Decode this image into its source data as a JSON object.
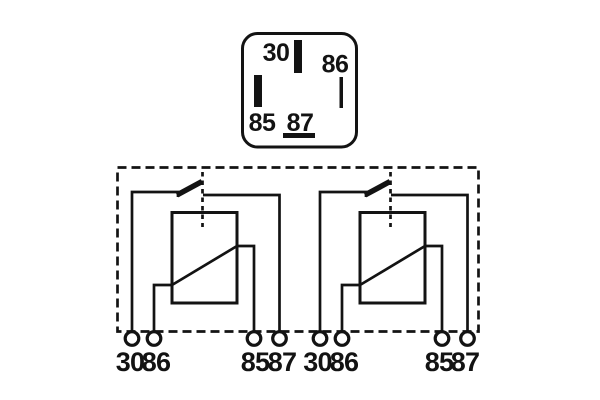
{
  "colors": {
    "ink": "#131313",
    "background": "#ffffff"
  },
  "socket": {
    "pin_labels": {
      "p30": "30",
      "p86": "86",
      "p85": "85",
      "p87": "87"
    }
  },
  "circuits": [
    {
      "terminal_labels": {
        "t30": "30",
        "t86": "86",
        "t85": "85",
        "t87": "87"
      }
    },
    {
      "terminal_labels": {
        "t30": "30",
        "t86": "86",
        "t85": "85",
        "t87": "87"
      }
    }
  ]
}
